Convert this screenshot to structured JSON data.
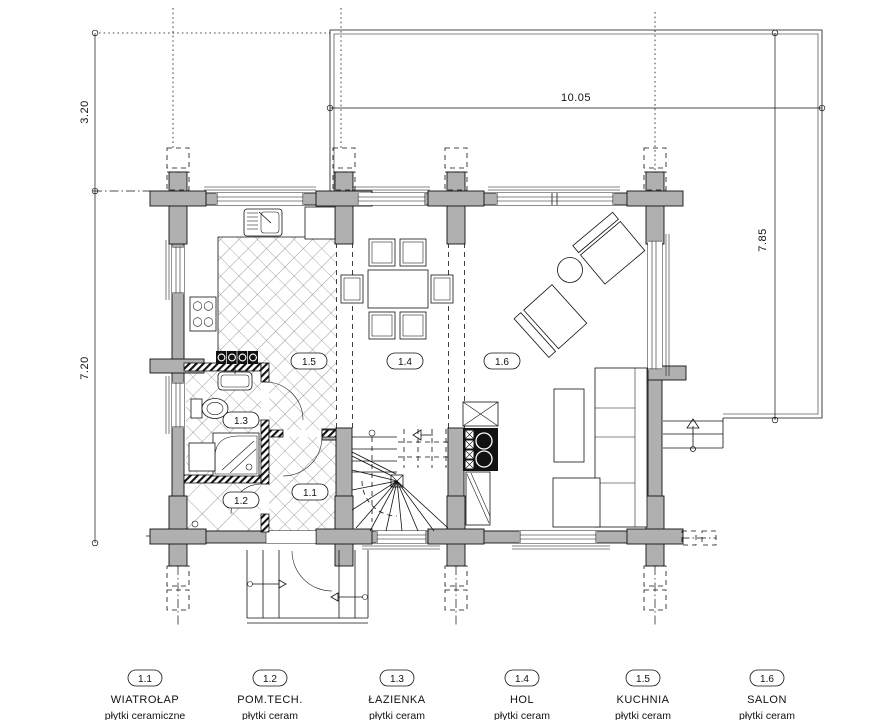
{
  "title": "rzut parteru - plan domu z bali",
  "dimensions": {
    "left_upper": "3.20",
    "left_lower": "7.20",
    "top": "10.05",
    "right": "7.85"
  },
  "legend": {
    "items": [
      {
        "no": "1.1",
        "name": "WIATROŁAP",
        "finish": "płytki ceramiczne"
      },
      {
        "no": "1.2",
        "name": "POM.TECH.",
        "finish": "płytki ceram"
      },
      {
        "no": "1.3",
        "name": "ŁAZIENKA",
        "finish": "płytki ceram"
      },
      {
        "no": "1.4",
        "name": "HOL",
        "finish": "płytki ceram"
      },
      {
        "no": "1.5",
        "name": "KUCHNIA",
        "finish": "płytki ceram"
      },
      {
        "no": "1.6",
        "name": "SALON",
        "finish": "płytki ceram"
      }
    ]
  },
  "colors": {
    "wall_gray": "#b0b0b0",
    "line": "#111111",
    "background": "#ffffff"
  }
}
